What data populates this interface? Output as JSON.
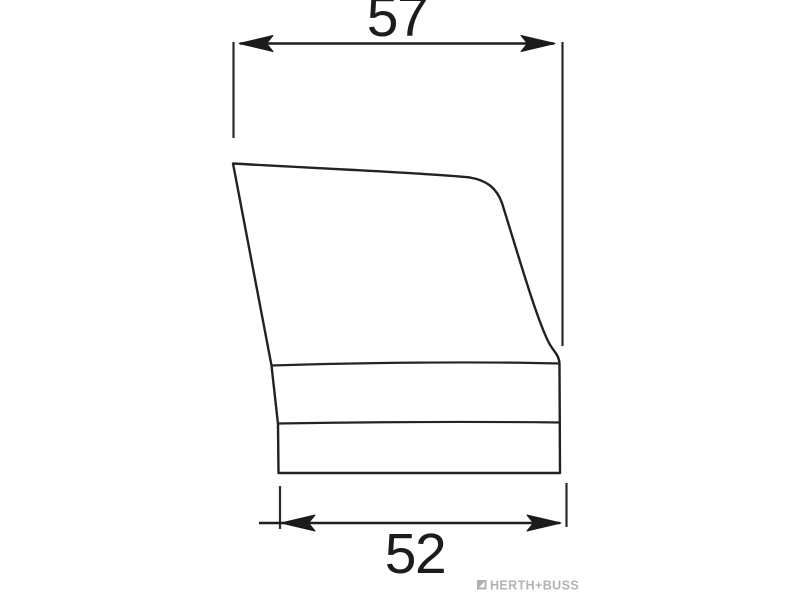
{
  "diagram": {
    "type": "technical-line-drawing",
    "dimensions": {
      "top_width_label": "57",
      "bottom_width_label": "52"
    },
    "branding": {
      "logo_text": "HERTH+BUSS"
    },
    "colors": {
      "line": "#222222",
      "logo_gray": "#b3b3b3",
      "background": "#ffffff"
    }
  }
}
